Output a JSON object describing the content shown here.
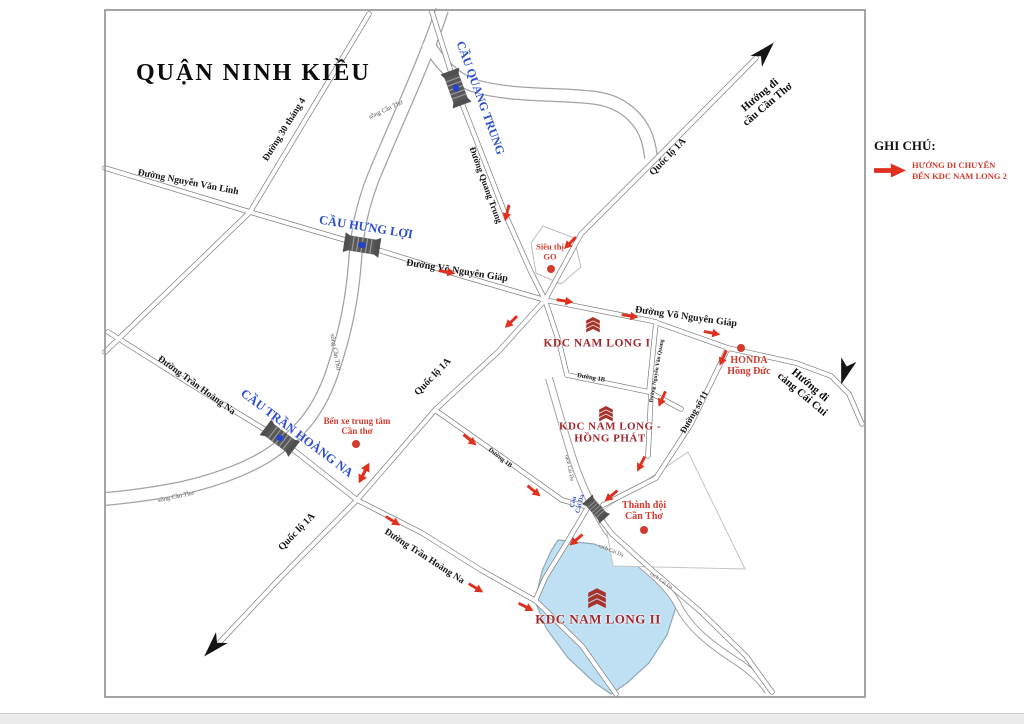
{
  "page": {
    "title": "QUẬN NINH KIỀU"
  },
  "legend": {
    "heading": "GHI CHÚ:",
    "line1": "HƯỚNG DI CHUYỂN",
    "line2": "ĐẾN KDC NAM LONG 2"
  },
  "colors": {
    "route_arrow": "#e0301e",
    "direction_arrow": "#151515",
    "bridge_label": "#2b4fd0",
    "poi_label": "#d23b2e",
    "kdc_label": "#a3282d",
    "kdc2_fill": "#bfe0f2"
  },
  "map": {
    "labels": [
      {
        "name": "road-label-nguyen-van-linh",
        "text": "Đường Nguyễn Văn Linh",
        "x": 188,
        "y": 183,
        "rot": 11,
        "size": 9.5,
        "style": "road"
      },
      {
        "name": "road-label-30-thang-4",
        "text": "Đường 30 tháng 4",
        "x": 285,
        "y": 130,
        "rot": -58,
        "size": 9.5,
        "style": "road"
      },
      {
        "name": "river-label-song-can-tho-1",
        "text": "sông Cần Thơ",
        "x": 386,
        "y": 110,
        "rot": -25,
        "size": 6.5,
        "style": "river"
      },
      {
        "name": "bridge-label-cau-quang-trung",
        "text": "CẦU QUANG TRUNG",
        "x": 480,
        "y": 98,
        "rot": 70,
        "size": 12,
        "style": "bridge"
      },
      {
        "name": "road-label-quang-trung",
        "text": "Đường Quang Trung",
        "x": 486,
        "y": 185,
        "rot": 70,
        "size": 9,
        "style": "road"
      },
      {
        "name": "road-label-quoc-lo-1a-top",
        "text": "Quốc lộ 1A",
        "x": 668,
        "y": 157,
        "rot": -46,
        "size": 10,
        "style": "road"
      },
      {
        "name": "direction-label-cau-can-tho",
        "text": "Hướng đi\ncầu Cần Thơ",
        "x": 764,
        "y": 100,
        "rot": -40,
        "size": 11,
        "style": "dir"
      },
      {
        "name": "bridge-label-cau-hung-loi",
        "text": "CẦU HƯNG LỢI",
        "x": 366,
        "y": 227,
        "rot": 9,
        "size": 12.5,
        "style": "bridge"
      },
      {
        "name": "road-label-vo-nguyen-giap-west",
        "text": "Đường Võ Nguyên Giáp",
        "x": 457,
        "y": 271,
        "rot": 9,
        "size": 10,
        "style": "road"
      },
      {
        "name": "poi-label-sieu-thi-go",
        "text": "Siêu thị\nGO",
        "x": 550,
        "y": 252,
        "rot": 0,
        "size": 8.5,
        "style": "poi"
      },
      {
        "name": "road-label-vo-nguyen-giap-east",
        "text": "Đường Võ Nguyên Giáp",
        "x": 686,
        "y": 317,
        "rot": 8,
        "size": 10,
        "style": "road"
      },
      {
        "name": "kdc-label-nam-long-1",
        "text": "KDC NAM LONG I",
        "x": 597,
        "y": 344,
        "rot": 0,
        "size": 11.5,
        "style": "kdc"
      },
      {
        "name": "poi-label-honda-hong-duc",
        "text": "HONDA\nHồng Đức",
        "x": 749,
        "y": 366,
        "rot": 0,
        "size": 10,
        "style": "poi"
      },
      {
        "name": "direction-label-cang-cai-cui",
        "text": "Hướng đi\ncảng Cái Cui",
        "x": 806,
        "y": 390,
        "rot": 40,
        "size": 11,
        "style": "dir"
      },
      {
        "name": "road-label-nguyen-van-quang",
        "text": "Đường Nguyễn Văn Quang",
        "x": 657,
        "y": 371,
        "rot": -80,
        "size": 5.5,
        "style": "road"
      },
      {
        "name": "road-label-duong-1b-north",
        "text": "Đường 1B",
        "x": 591,
        "y": 378,
        "rot": 10,
        "size": 6.5,
        "style": "road"
      },
      {
        "name": "road-label-duong-so-11",
        "text": "Đường số 11",
        "x": 694,
        "y": 412,
        "rot": -60,
        "size": 9,
        "style": "road"
      },
      {
        "name": "kdc-label-nam-long-hong-phat",
        "text": "KDC NAM LONG -\nHỒNG PHÁT",
        "x": 610,
        "y": 433,
        "rot": 0,
        "size": 11,
        "style": "kdc"
      },
      {
        "name": "river-label-song-can-tho-2",
        "text": "sông Cần Thơ",
        "x": 335,
        "y": 352,
        "rot": 80,
        "size": 6.5,
        "style": "river"
      },
      {
        "name": "road-label-tran-hoang-na-west",
        "text": "Đường Trần Hoàng Na",
        "x": 196,
        "y": 386,
        "rot": 36,
        "size": 9.5,
        "style": "road"
      },
      {
        "name": "bridge-label-cau-tran-hoang-na",
        "text": "CẦU TRẦN HOÀNG NA",
        "x": 297,
        "y": 433,
        "rot": 37,
        "size": 12.5,
        "style": "bridge"
      },
      {
        "name": "poi-label-ben-xe",
        "text": "Bến xe trung tâm\nCần thơ",
        "x": 357,
        "y": 426,
        "rot": 0,
        "size": 9,
        "style": "poi"
      },
      {
        "name": "road-label-quoc-lo-1a-mid",
        "text": "Quốc lộ 1A",
        "x": 433,
        "y": 377,
        "rot": -46,
        "size": 10,
        "style": "road"
      },
      {
        "name": "road-label-duong-1b-south",
        "text": "Đường 1B",
        "x": 500,
        "y": 458,
        "rot": 38,
        "size": 6.5,
        "style": "road"
      },
      {
        "name": "river-label-song-can-tho-3",
        "text": "sông Cần Thơ",
        "x": 176,
        "y": 497,
        "rot": -12,
        "size": 6.5,
        "style": "river"
      },
      {
        "name": "road-label-quoc-lo-1a-south",
        "text": "Quốc lộ 1A",
        "x": 297,
        "y": 532,
        "rot": -46,
        "size": 10,
        "style": "road"
      },
      {
        "name": "road-label-tran-hoang-na-south",
        "text": "Đường Trần Hoàng Na",
        "x": 424,
        "y": 557,
        "rot": 33,
        "size": 9.5,
        "style": "road"
      },
      {
        "name": "bridge-label-cau-cai-da",
        "text": "Cầu\nCái Da",
        "x": 577,
        "y": 503,
        "rot": -75,
        "size": 6.5,
        "style": "bridge"
      },
      {
        "name": "poi-label-thanh-doi",
        "text": "Thành đội\nCần Thơ",
        "x": 644,
        "y": 511,
        "rot": 0,
        "size": 10,
        "style": "poi"
      },
      {
        "name": "river-label-rach-cai-da-1",
        "text": "rạch Cái Da",
        "x": 569,
        "y": 468,
        "rot": 78,
        "size": 5.5,
        "style": "river"
      },
      {
        "name": "river-label-rach-cai-da-2",
        "text": "rạch Cái Da",
        "x": 611,
        "y": 551,
        "rot": 22,
        "size": 5.5,
        "style": "river"
      },
      {
        "name": "river-label-rach-cai-da-3",
        "text": "rạch Cái Da",
        "x": 661,
        "y": 581,
        "rot": 35,
        "size": 5.5,
        "style": "river"
      },
      {
        "name": "kdc-label-nam-long-2",
        "text": "KDC NAM LONG II",
        "x": 598,
        "y": 620,
        "rot": 0,
        "size": 13,
        "style": "kdc"
      }
    ],
    "dots": [
      {
        "name": "poi-dot-sieu-thi-go",
        "x": 551,
        "y": 269
      },
      {
        "name": "poi-dot-honda",
        "x": 741,
        "y": 348
      },
      {
        "name": "poi-dot-ben-xe",
        "x": 356,
        "y": 444
      },
      {
        "name": "poi-dot-thanh-doi",
        "x": 644,
        "y": 530
      }
    ],
    "route_arrows": [
      {
        "x": 507,
        "y": 213,
        "a": 104
      },
      {
        "x": 570,
        "y": 243,
        "a": 135
      },
      {
        "x": 447,
        "y": 272,
        "a": 10
      },
      {
        "x": 565,
        "y": 301,
        "a": 9
      },
      {
        "x": 630,
        "y": 316,
        "a": 9
      },
      {
        "x": 712,
        "y": 333,
        "a": 11
      },
      {
        "x": 511,
        "y": 322,
        "a": 136
      },
      {
        "x": 723,
        "y": 358,
        "a": 114
      },
      {
        "x": 662,
        "y": 399,
        "a": 114
      },
      {
        "x": 641,
        "y": 464,
        "a": 117
      },
      {
        "x": 611,
        "y": 496,
        "a": 140
      },
      {
        "x": 576,
        "y": 540,
        "a": 140
      },
      {
        "x": 470,
        "y": 440,
        "a": 39
      },
      {
        "x": 534,
        "y": 491,
        "a": 39
      },
      {
        "x": 364,
        "y": 473,
        "a": 117,
        "double": true
      },
      {
        "x": 393,
        "y": 521,
        "a": 32
      },
      {
        "x": 476,
        "y": 588,
        "a": 31
      },
      {
        "x": 526,
        "y": 607,
        "a": 27
      }
    ],
    "direction_arrows": [
      {
        "name": "arrow-to-cau-can-tho",
        "x": 765,
        "y": 52,
        "a": -47
      },
      {
        "name": "arrow-to-cang-cai-cui",
        "x": 845,
        "y": 372,
        "a": 107
      },
      {
        "name": "arrow-quoc-lo-1a-southwest",
        "x": 213,
        "y": 647,
        "a": 133
      }
    ]
  }
}
